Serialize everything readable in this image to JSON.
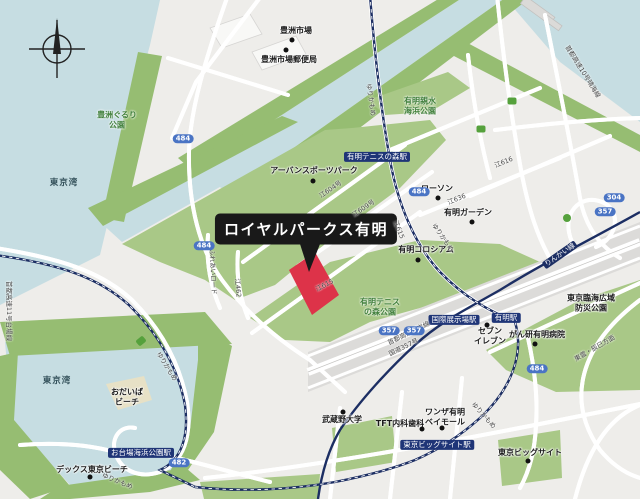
{
  "map": {
    "callout": {
      "label": "ロイヤルパークス有明",
      "x": 306,
      "y": 229
    },
    "colors": {
      "land": "#eeedea",
      "water": "#c6dde2",
      "park_green": "#a9c887",
      "shore_green": "#96bd72",
      "rail_navy": "#1c2e63",
      "route_badge_blue": "#4a74c4",
      "highlight_red": "#dd3349",
      "callout_black": "#191919",
      "park_text_green": "#41803c"
    },
    "labels": [
      {
        "name": "station-ariake-tennis-no-mori",
        "type": "station",
        "t": "有明テニスの森駅",
        "x": 377,
        "y": 157,
        "rot": 0
      },
      {
        "name": "station-kokusai-tenjijo",
        "type": "station",
        "t": "国際展示場駅",
        "x": 454,
        "y": 320,
        "rot": 0
      },
      {
        "name": "station-ariake",
        "type": "station",
        "t": "有明駅",
        "x": 506,
        "y": 318,
        "rot": 0
      },
      {
        "name": "station-tokyo-big-sight",
        "type": "station",
        "t": "東京ビッグサイト駅",
        "x": 437,
        "y": 445,
        "rot": 0
      },
      {
        "name": "station-odaiba-kaihin-koen",
        "type": "station",
        "t": "お台場海浜公園駅",
        "x": 141,
        "y": 453,
        "rot": 0
      },
      {
        "name": "poi-toyosu-market",
        "type": "poi",
        "t": "豊洲市場",
        "x": 296,
        "y": 31,
        "rot": 0,
        "dot": [
          292,
          40
        ]
      },
      {
        "name": "poi-toyosu-post-office",
        "type": "poi",
        "t": "豊洲市場郵便局",
        "x": 289,
        "y": 60,
        "rot": 0,
        "dot": [
          286,
          50
        ]
      },
      {
        "name": "poi-urban-sports-park",
        "type": "poi",
        "t": "アーバンスポーツパーク",
        "x": 314,
        "y": 171,
        "rot": 0,
        "dot": [
          313,
          181
        ]
      },
      {
        "name": "poi-lawson",
        "type": "poi",
        "t": "ローソン",
        "x": 437,
        "y": 189,
        "rot": 0,
        "dot": [
          438,
          198
        ]
      },
      {
        "name": "poi-ariake-garden",
        "type": "poi",
        "t": "有明ガーデン",
        "x": 468,
        "y": 213,
        "rot": 0,
        "dot": [
          472,
          222
        ]
      },
      {
        "name": "poi-ariake-coliseum",
        "type": "poi",
        "t": "有明コロシアム",
        "x": 426,
        "y": 250,
        "rot": 0,
        "dot": [
          418,
          260
        ]
      },
      {
        "name": "poi-seven-eleven",
        "type": "poi",
        "t": "セブン\nイレブン",
        "x": 490,
        "y": 336,
        "rot": 0,
        "dot": [
          487,
          325
        ]
      },
      {
        "name": "poi-ganken-ariake-hospital",
        "type": "poi",
        "t": "がん研有明病院",
        "x": 537,
        "y": 335,
        "rot": 0,
        "dot": [
          535,
          344
        ]
      },
      {
        "name": "poi-wanza-ariake-bay-mall",
        "type": "poi",
        "t": "ワンザ有明\nベイモール",
        "x": 445,
        "y": 417,
        "rot": 0,
        "dot": [
          442,
          428
        ]
      },
      {
        "name": "poi-tft-clinic",
        "type": "poi",
        "t": "TFT内科歯科",
        "x": 400,
        "y": 424,
        "rot": 0,
        "dot": [
          422,
          429
        ]
      },
      {
        "name": "poi-musashino-university",
        "type": "poi",
        "t": "武蔵野大学",
        "x": 342,
        "y": 420,
        "rot": 0,
        "dot": [
          343,
          412
        ]
      },
      {
        "name": "poi-tokyo-big-sight",
        "type": "poi",
        "t": "東京ビッグサイト",
        "x": 530,
        "y": 453,
        "rot": 0,
        "dot": [
          528,
          461
        ]
      },
      {
        "name": "poi-decks-tokyo-beach",
        "type": "poi",
        "t": "デックス東京ビーチ",
        "x": 92,
        "y": 470,
        "rot": 0,
        "dot": [
          90,
          477
        ]
      },
      {
        "name": "poi-odaiba-beach",
        "type": "poi",
        "t": "おだいば\nビーチ",
        "x": 127,
        "y": 397,
        "rot": 0
      },
      {
        "name": "poi-bousai-park",
        "type": "poi",
        "t": "東京臨海広域防災公園",
        "x": 591,
        "y": 303,
        "rot": 0
      },
      {
        "name": "park-toyosu-gururi",
        "type": "park",
        "t": "豊洲ぐるり\n公園",
        "x": 117,
        "y": 120,
        "rot": 0
      },
      {
        "name": "park-ariake-shinsui",
        "type": "park",
        "t": "有明親水\n海浜公園",
        "x": 420,
        "y": 106,
        "rot": 0
      },
      {
        "name": "park-ariake-tennis-no-mori",
        "type": "park",
        "t": "有明テニス\nの森公園",
        "x": 380,
        "y": 307,
        "rot": 0
      },
      {
        "name": "water-tokyo-bay-upper",
        "type": "water",
        "t": "東京湾",
        "x": 64,
        "y": 183,
        "rot": 0
      },
      {
        "name": "water-tokyo-bay-lower",
        "type": "water",
        "t": "東京湾",
        "x": 57,
        "y": 381,
        "rot": 0
      },
      {
        "name": "road-yurikamome-1",
        "type": "road",
        "t": "ゆりかもめ",
        "x": 370,
        "y": 100,
        "rot": 82
      },
      {
        "name": "road-yurikamome-2",
        "type": "road",
        "t": "ゆりかもめ",
        "x": 442,
        "y": 238,
        "rot": 55
      },
      {
        "name": "road-yurikamome-3",
        "type": "road",
        "t": "ゆりかもめ",
        "x": 483,
        "y": 416,
        "rot": 48
      },
      {
        "name": "road-yurikamome-4",
        "type": "road",
        "t": "ゆりかもめ",
        "x": 166,
        "y": 367,
        "rot": 58
      },
      {
        "name": "road-yurikamome-5",
        "type": "road",
        "t": "ゆりかもめ",
        "x": 117,
        "y": 482,
        "rot": 22
      },
      {
        "name": "rail-rinkai-line",
        "type": "railname",
        "t": "りんかい線",
        "x": 560,
        "y": 255,
        "rot": -35
      },
      {
        "name": "road-e604",
        "type": "road",
        "t": "江604号",
        "x": 331,
        "y": 190,
        "rot": -34
      },
      {
        "name": "road-e609",
        "type": "road",
        "t": "江609号",
        "x": 364,
        "y": 209,
        "rot": -34
      },
      {
        "name": "road-e615-a",
        "type": "road",
        "t": "江615",
        "x": 325,
        "y": 286,
        "rot": -28
      },
      {
        "name": "road-e615-b",
        "type": "road",
        "t": "江615",
        "x": 398,
        "y": 230,
        "rot": 68
      },
      {
        "name": "road-e462",
        "type": "road",
        "t": "江462",
        "x": 237,
        "y": 288,
        "rot": 85
      },
      {
        "name": "road-fureai",
        "type": "road",
        "t": "ふれあいロード",
        "x": 212,
        "y": 272,
        "rot": 87
      },
      {
        "name": "road-e636",
        "type": "road",
        "t": "江636",
        "x": 457,
        "y": 200,
        "rot": -22
      },
      {
        "name": "road-e616",
        "type": "road",
        "t": "江616",
        "x": 504,
        "y": 163,
        "rot": -22
      },
      {
        "name": "road-shuto-wangan-line",
        "type": "road",
        "t": "首都高速湾岸線",
        "x": 409,
        "y": 334,
        "rot": -26
      },
      {
        "name": "road-route-357",
        "type": "road",
        "t": "国道357号",
        "x": 404,
        "y": 348,
        "rot": -26
      },
      {
        "name": "road-shinonome-tatsumi",
        "type": "road",
        "t": "東雲・辰巳方面",
        "x": 595,
        "y": 349,
        "rot": -30
      },
      {
        "name": "road-shuto-10-harumi",
        "type": "road",
        "t": "首都高速10号晴海線",
        "x": 582,
        "y": 72,
        "rot": 58
      },
      {
        "name": "road-shuto-11-daiba",
        "type": "road",
        "t": "首都高速11号台場線",
        "x": 8,
        "y": 311,
        "rot": 90
      },
      {
        "name": "badge-484-a",
        "type": "badge",
        "t": "484",
        "x": 183,
        "y": 139,
        "rot": 0
      },
      {
        "name": "badge-484-b",
        "type": "badge",
        "t": "484",
        "x": 204,
        "y": 246,
        "rot": 0
      },
      {
        "name": "badge-484-c",
        "type": "badge",
        "t": "484",
        "x": 419,
        "y": 192,
        "rot": 0
      },
      {
        "name": "badge-484-d",
        "type": "badge",
        "t": "484",
        "x": 537,
        "y": 369,
        "rot": 0
      },
      {
        "name": "badge-482",
        "type": "badge",
        "t": "482",
        "x": 179,
        "y": 463,
        "rot": 0
      },
      {
        "name": "badge-304",
        "type": "badge",
        "t": "304",
        "x": 614,
        "y": 198,
        "rot": 0
      },
      {
        "name": "badge-357-a",
        "type": "badge",
        "t": "357",
        "x": 605,
        "y": 212,
        "rot": 0
      },
      {
        "name": "badge-357-b",
        "type": "badge",
        "t": "357",
        "x": 389,
        "y": 331,
        "rot": 0
      },
      {
        "name": "badge-357-c",
        "type": "badge",
        "t": "357",
        "x": 414,
        "y": 331,
        "rot": 0
      },
      {
        "name": "marker-expressway-a",
        "type": "badge-green",
        "t": "",
        "x": 512,
        "y": 101,
        "rot": 0
      },
      {
        "name": "marker-expressway-b",
        "type": "badge-green",
        "t": "",
        "x": 481,
        "y": 129,
        "rot": 0
      },
      {
        "name": "marker-interchange",
        "type": "badge-green-round",
        "t": "",
        "x": 567,
        "y": 218,
        "rot": 0
      },
      {
        "name": "marker-station-green",
        "type": "badge-green",
        "t": "",
        "x": 141,
        "y": 341,
        "rot": -40
      }
    ]
  }
}
